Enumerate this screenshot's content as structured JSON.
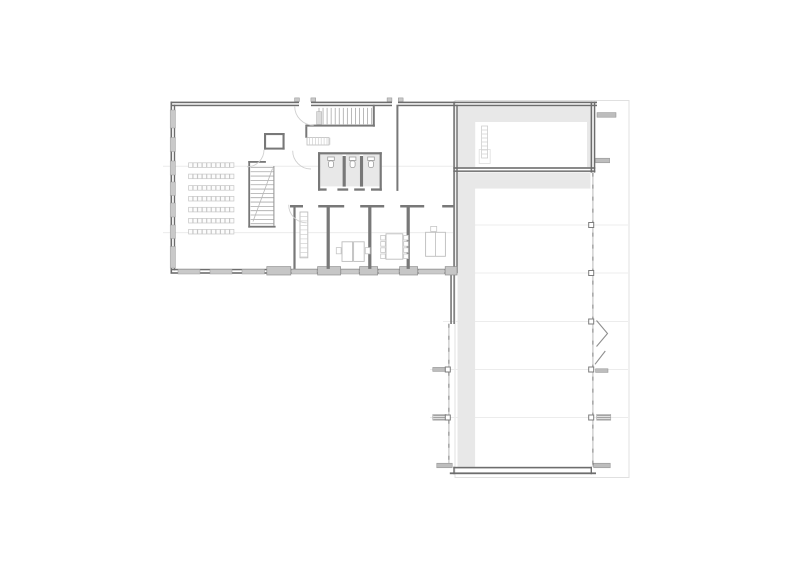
{
  "canvas": {
    "width": 800,
    "height": 566,
    "background": "#ffffff"
  },
  "colors": {
    "wall": "#6d6d6d",
    "interior_wall": "#787878",
    "window": "#c9c9c9",
    "pier": "#c6c6c6",
    "floor_shading": "#e8e8e8",
    "faint_line": "#ececec",
    "canopy_outline": "#e0e0e0",
    "furniture": "#bdbdbd",
    "fixture": "#9f9f9f",
    "stub": "#bdbdbd",
    "glass": "#c4c4c4",
    "glass_dash": "#8f8f8f",
    "seat": "#c6c6c6",
    "tread": "#a8a8a8",
    "door_swing": "#cfcfcf",
    "chevron": "#8f8f8f"
  },
  "layers": [
    {
      "name": "canopy-outline",
      "kind": "rect",
      "stroke": "#e0e0e0",
      "sw": 1,
      "fill": "none",
      "items": [
        [
          455,
          100.5,
          174,
          377
        ]
      ]
    },
    {
      "name": "faint-grid-line",
      "kind": "line",
      "stroke": "#ececec",
      "sw": 1,
      "items": [
        [
          163,
          166.3,
          453,
          166.3
        ],
        [
          163,
          232.6,
          453,
          232.6
        ],
        [
          457,
          225,
          628,
          225
        ],
        [
          457,
          273,
          628,
          273
        ],
        [
          443,
          321.5,
          628,
          321.5
        ],
        [
          430,
          369.5,
          628,
          369.5
        ],
        [
          430,
          417.5,
          628,
          417.5
        ]
      ]
    },
    {
      "name": "floor-shading",
      "kind": "rect",
      "fill": "#e8e8e8",
      "items": [
        [
          457.5,
          106.3,
          133,
          60.8
        ],
        [
          457.5,
          172.4,
          133,
          16.2
        ],
        [
          457.5,
          188.5,
          17.6,
          278.3
        ],
        [
          320.3,
          154.4,
          22.2,
          32
        ],
        [
          346,
          154.4,
          13.6,
          32
        ],
        [
          363.2,
          154.4,
          16.4,
          32
        ]
      ]
    },
    {
      "name": "floor-shading-inset",
      "kind": "rect",
      "fill": "#ffffff",
      "items": [
        [
          475.2,
          122,
          111.8,
          45
        ]
      ]
    },
    {
      "name": "ladder-landing",
      "kind": "rect",
      "stroke": "#dedede",
      "sw": 0.8,
      "fill": "none",
      "items": [
        [
          479.2,
          149.5,
          11,
          14
        ]
      ]
    },
    {
      "name": "ladder-outline",
      "kind": "rect",
      "stroke": "#cfcfcf",
      "sw": 0.8,
      "fill": "none",
      "items": [
        [
          481.6,
          126,
          6,
          32
        ]
      ]
    },
    {
      "name": "ladder-rungs",
      "kind": "repeat-line",
      "stroke": "#cfcfcf",
      "sw": 0.7,
      "items": [
        [
          481.6,
          130,
          487.6,
          130,
          0,
          4,
          7
        ]
      ]
    },
    {
      "name": "exterior-wall",
      "kind": "rect",
      "fill": "#6d6d6d",
      "items": [
        [
          170.5,
          101.6,
          128.5,
          1.6
        ],
        [
          311,
          101.6,
          81,
          1.6
        ],
        [
          398,
          101.6,
          199,
          1.6
        ],
        [
          170.5,
          104.7,
          128.5,
          1.5
        ],
        [
          311,
          104.7,
          81,
          1.5
        ],
        [
          398,
          104.7,
          199,
          1.5
        ],
        [
          170.5,
          101.6,
          1.6,
          171.6
        ],
        [
          173.8,
          104.7,
          1.4,
          165.6
        ],
        [
          170.5,
          268.8,
          286.5,
          1.5
        ],
        [
          170.5,
          272.2,
          286.5,
          1.6
        ],
        [
          453.3,
          101.6,
          1.5,
          171.6
        ],
        [
          456.3,
          104.7,
          1.4,
          168.5
        ],
        [
          450.3,
          270.7,
          1.5,
          53.3
        ],
        [
          453.4,
          270.7,
          1.4,
          53.3
        ],
        [
          590.6,
          101.6,
          1.6,
          71
        ],
        [
          593.8,
          101.6,
          1.5,
          71
        ],
        [
          453.3,
          167.2,
          142,
          1.6
        ],
        [
          453.3,
          170.4,
          142,
          1.5
        ],
        [
          453.3,
          466.8,
          138.6,
          1.6
        ],
        [
          449.8,
          472.4,
          146.2,
          1.8
        ],
        [
          453.3,
          466.8,
          1.4,
          7.4
        ],
        [
          590.6,
          466.8,
          1.4,
          7.4
        ]
      ]
    },
    {
      "name": "window",
      "kind": "rect",
      "fill": "#c9c9c9",
      "stroke": "#9c9c9c",
      "sw": 0.5,
      "items": [
        [
          170.2,
          110,
          5.2,
          18
        ],
        [
          170.2,
          137.5,
          5.2,
          14
        ],
        [
          170.2,
          161,
          5.2,
          14
        ],
        [
          170.2,
          182,
          5.2,
          13.5
        ],
        [
          170.2,
          203,
          5.2,
          14
        ],
        [
          170.2,
          225,
          5.2,
          13.5
        ],
        [
          170.2,
          246.5,
          5.2,
          21.5
        ],
        [
          178,
          269.4,
          22,
          4.6
        ],
        [
          210,
          269.4,
          22,
          4.6
        ],
        [
          242,
          269.4,
          22.5,
          4.6
        ],
        [
          291.5,
          269.4,
          25.5,
          4.6
        ],
        [
          341,
          269.4,
          18,
          4.6
        ],
        [
          378.5,
          269.4,
          20.5,
          4.6
        ],
        [
          418.5,
          269.4,
          26,
          4.6
        ]
      ]
    },
    {
      "name": "facade-pier",
      "kind": "rect",
      "fill": "#c6c6c6",
      "stroke": "#8f8f8f",
      "sw": 0.7,
      "items": [
        [
          266.8,
          266.6,
          24,
          8.4
        ],
        [
          317.6,
          266.6,
          23,
          8.4
        ],
        [
          359.6,
          266.6,
          18,
          8.4
        ],
        [
          399.6,
          266.6,
          18,
          8.4
        ],
        [
          445.2,
          266.6,
          11.8,
          8.4
        ]
      ]
    },
    {
      "name": "interior-wall",
      "kind": "rect",
      "fill": "#787878",
      "items": [
        [
          248.3,
          161,
          1.8,
          66.6
        ],
        [
          248.3,
          225.8,
          27.3,
          1.8
        ],
        [
          248.3,
          161,
          17.6,
          1.8
        ],
        [
          264,
          133,
          20.6,
          2.1
        ],
        [
          264,
          133,
          2.1,
          16.6
        ],
        [
          282.5,
          133,
          2.1,
          16.6
        ],
        [
          264,
          147.6,
          20.6,
          2
        ],
        [
          305.3,
          124.6,
          69.6,
          2
        ],
        [
          372.8,
          104.7,
          2,
          22
        ],
        [
          305.3,
          126.6,
          2,
          11.2
        ],
        [
          396.4,
          104.7,
          2,
          86.2
        ],
        [
          318,
          152.2,
          63.8,
          2.2
        ],
        [
          318,
          152.2,
          2.2,
          38.5
        ],
        [
          379.6,
          152.2,
          2.2,
          38.5
        ],
        [
          342.6,
          156,
          3.2,
          30.6
        ],
        [
          359.9,
          156,
          3.2,
          30.6
        ],
        [
          318,
          188.4,
          8.6,
          2.3
        ],
        [
          337.4,
          188.4,
          10.8,
          2.3
        ],
        [
          354.2,
          188.4,
          10.6,
          2.3
        ],
        [
          371,
          188.4,
          10.8,
          2.3
        ],
        [
          290,
          205,
          13,
          2.5
        ],
        [
          318.2,
          205,
          26,
          2.5
        ],
        [
          360.2,
          205,
          24,
          2.5
        ],
        [
          400.2,
          205,
          24,
          2.5
        ],
        [
          442.2,
          205,
          11.2,
          2.5
        ],
        [
          293.4,
          207.5,
          2.2,
          61.4
        ],
        [
          326.6,
          207.5,
          3.2,
          61.4
        ],
        [
          368.2,
          207.5,
          3.2,
          61.4
        ],
        [
          406.6,
          207.5,
          3.2,
          61.4
        ]
      ]
    },
    {
      "name": "glass-wall",
      "kind": "line",
      "stroke": "#c4c4c4",
      "sw": 1.2,
      "items": [
        [
          448.9,
          323.8,
          448.9,
          466.8
        ],
        [
          592.9,
          172.6,
          592.9,
          466.8
        ]
      ]
    },
    {
      "name": "glass-wall-dashes",
      "kind": "line",
      "stroke": "#8f8f8f",
      "sw": 1.2,
      "dash": "4 8",
      "items": [
        [
          448.9,
          323.8,
          448.9,
          466.8
        ],
        [
          592.9,
          172.6,
          592.9,
          466.8
        ]
      ]
    },
    {
      "name": "stair-treads-lower",
      "kind": "repeat-line",
      "stroke": "#a8a8a8",
      "sw": 0.8,
      "items": [
        [
          250.6,
          167.4,
          273.4,
          167.4,
          0,
          4.33,
          14
        ]
      ]
    },
    {
      "name": "stair-rail",
      "kind": "line",
      "stroke": "#8f8f8f",
      "sw": 1,
      "items": [
        [
          273.9,
          166,
          273.9,
          225.8
        ]
      ]
    },
    {
      "name": "stair-cut-line",
      "kind": "line",
      "stroke": "#b8b8b8",
      "sw": 0.8,
      "items": [
        [
          272.5,
          168.5,
          253,
          221.5
        ]
      ]
    },
    {
      "name": "stair-treads-upper",
      "kind": "repeat-line",
      "stroke": "#a8a8a8",
      "sw": 0.8,
      "items": [
        [
          319,
          107.9,
          319,
          124.3,
          4.05,
          0,
          14
        ]
      ]
    },
    {
      "name": "stair-newel",
      "kind": "rect",
      "fill": "#dcdcdc",
      "stroke": "#a8a8a8",
      "sw": 0.5,
      "items": [
        [
          316.6,
          111.6,
          5,
          12.8
        ]
      ]
    },
    {
      "name": "kitchen-counter",
      "kind": "rect",
      "fill": "#ffffff",
      "stroke": "#bdbdbd",
      "sw": 0.8,
      "items": [
        [
          307,
          137.6,
          22,
          7.4
        ]
      ]
    },
    {
      "name": "kitchen-counter-ticks",
      "kind": "repeat-line",
      "stroke": "#d0d0d0",
      "sw": 0.7,
      "items": [
        [
          309.6,
          137.8,
          309.6,
          144.8,
          2.9,
          0,
          8
        ]
      ]
    },
    {
      "name": "furniture",
      "kind": "rect",
      "fill": "#ffffff",
      "stroke": "#bdbdbd",
      "sw": 0.9,
      "items": [
        [
          300,
          212,
          7.8,
          45.8
        ],
        [
          342,
          241.8,
          10.6,
          19.6
        ],
        [
          353.6,
          241.8,
          10.6,
          19.6
        ],
        [
          386,
          233.8,
          16.8,
          25.4
        ],
        [
          425.6,
          232.3,
          19.8,
          24
        ]
      ]
    },
    {
      "name": "shelf-ticks",
      "kind": "repeat-line",
      "stroke": "#d0d0d0",
      "sw": 0.7,
      "items": [
        [
          300,
          216.4,
          307.8,
          216.4,
          0,
          4.5,
          10
        ]
      ]
    },
    {
      "name": "desk-divider",
      "kind": "line",
      "stroke": "#bdbdbd",
      "sw": 0.8,
      "items": [
        [
          435.5,
          232.3,
          435.5,
          256.3
        ]
      ]
    },
    {
      "name": "chair",
      "kind": "repeat-rect",
      "fill": "#ffffff",
      "stroke": "#c6c6c6",
      "sw": 0.8,
      "items": [
        [
          336.3,
          247.6,
          4.8,
          6.2,
          0,
          0,
          1
        ],
        [
          365.3,
          247.6,
          4.8,
          6.2,
          0,
          0,
          1
        ],
        [
          430.7,
          226.4,
          6,
          5,
          0,
          0,
          1
        ],
        [
          380.7,
          235.4,
          4.6,
          4.6,
          0,
          6.2,
          4
        ],
        [
          403.7,
          235.4,
          4.6,
          4.6,
          0,
          6.2,
          4
        ]
      ]
    },
    {
      "name": "auditorium-seat-row",
      "kind": "repeat-rect",
      "fill": "#fcfcfc",
      "stroke": "#c6c6c6",
      "sw": 0.7,
      "items": [
        [
          188.6,
          162.8,
          4.1,
          4.6,
          4.58,
          0,
          10
        ],
        [
          188.6,
          174.1,
          4.1,
          4.6,
          4.58,
          0,
          10
        ],
        [
          188.6,
          185.6,
          4.1,
          4.6,
          4.58,
          0,
          10
        ],
        [
          188.6,
          196.4,
          4.1,
          4.6,
          4.58,
          0,
          10
        ],
        [
          188.6,
          207.3,
          4.1,
          4.6,
          4.58,
          0,
          10
        ],
        [
          188.6,
          218.4,
          4.1,
          4.6,
          4.58,
          0,
          10
        ],
        [
          188.6,
          229.4,
          4.1,
          4.6,
          4.58,
          0,
          10
        ]
      ]
    },
    {
      "name": "toilet-tank",
      "kind": "rect",
      "fill": "#ffffff",
      "stroke": "#9f9f9f",
      "sw": 0.8,
      "items": [
        [
          327.7,
          157,
          6.6,
          3.4
        ],
        [
          349.3,
          157,
          6.6,
          3.4
        ],
        [
          367.7,
          157,
          6.6,
          3.4
        ]
      ]
    },
    {
      "name": "toilet-bowl",
      "kind": "rect",
      "fill": "#ffffff",
      "stroke": "#9f9f9f",
      "sw": 0.8,
      "rx": 2,
      "items": [
        [
          328.5,
          160.9,
          5,
          6.6
        ],
        [
          350.1,
          160.9,
          5,
          6.6
        ],
        [
          368.5,
          160.9,
          5,
          6.6
        ]
      ]
    },
    {
      "name": "facade-stub",
      "kind": "rect",
      "fill": "#bdbdbd",
      "stroke": "#8a8a8a",
      "sw": 0.5,
      "items": [
        [
          597,
          112.6,
          19,
          4.6
        ],
        [
          595.4,
          158.2,
          14.2,
          4.6
        ],
        [
          432.8,
          367.4,
          12.4,
          4
        ],
        [
          595.6,
          368.8,
          12.4,
          3.6
        ],
        [
          436.8,
          463.2,
          15.4,
          4.6
        ],
        [
          593.7,
          463.2,
          16.5,
          4.6
        ]
      ]
    },
    {
      "name": "vent-stub",
      "kind": "rect",
      "fill": "#e2e2e2",
      "stroke": "#9a9a9a",
      "sw": 0.5,
      "items": [
        [
          432.8,
          414.4,
          13.4,
          5.8
        ],
        [
          596.6,
          414.4,
          14.2,
          5.8
        ]
      ]
    },
    {
      "name": "vent-stripes",
      "kind": "repeat-line",
      "stroke": "#8a8a8a",
      "sw": 0.7,
      "items": [
        [
          433.2,
          415.5,
          445.8,
          415.5,
          0,
          1.9,
          3
        ],
        [
          597,
          415.5,
          610.4,
          415.5,
          0,
          1.9,
          3
        ]
      ]
    },
    {
      "name": "structural-column",
      "kind": "rect",
      "fill": "#ffffff",
      "stroke": "#7d7d7d",
      "sw": 1,
      "items": [
        [
          588.7,
          222.5,
          5,
          5
        ],
        [
          588.7,
          270.5,
          5,
          5
        ],
        [
          588.7,
          319,
          5,
          5
        ],
        [
          588.7,
          367,
          5,
          5
        ],
        [
          588.7,
          415,
          5,
          5
        ],
        [
          445.3,
          367,
          5,
          5
        ],
        [
          445.3,
          415,
          5,
          5
        ]
      ]
    },
    {
      "name": "folding-door-chevron",
      "kind": "polyline",
      "stroke": "#8f8f8f",
      "sw": 1.1,
      "fill": "none",
      "items": [
        "596.5,320.5 607.5,333.5 596.5,346.5"
      ]
    },
    {
      "name": "door-leaf-diagonal",
      "kind": "line",
      "stroke": "#8f8f8f",
      "sw": 1.1,
      "items": [
        [
          605.3,
          351,
          595,
          364.3
        ]
      ]
    },
    {
      "name": "door-swing-arc",
      "kind": "path",
      "stroke": "#cfcfcf",
      "sw": 0.9,
      "fill": "none",
      "items": [
        "M 264 149.8 A 17 17 0 0 1 247 166.8",
        "M 288.7 204.8 A 18 18 0 0 0 306.7 222.8",
        "M 292.7 150.7 A 18.3 18.3 0 0 0 311 169",
        "M 294.7 106.2 A 19 19 0 0 0 313.7 125.2"
      ]
    },
    {
      "name": "entrance-tab",
      "kind": "rect",
      "fill": "#c9c9c9",
      "stroke": "#8f8f8f",
      "sw": 0.5,
      "items": [
        [
          294.6,
          97.9,
          4.8,
          3.6
        ],
        [
          310.9,
          97.9,
          4.8,
          3.6
        ],
        [
          387.1,
          97.9,
          4.8,
          3.6
        ],
        [
          398.3,
          97.9,
          4.8,
          3.6
        ]
      ]
    }
  ]
}
